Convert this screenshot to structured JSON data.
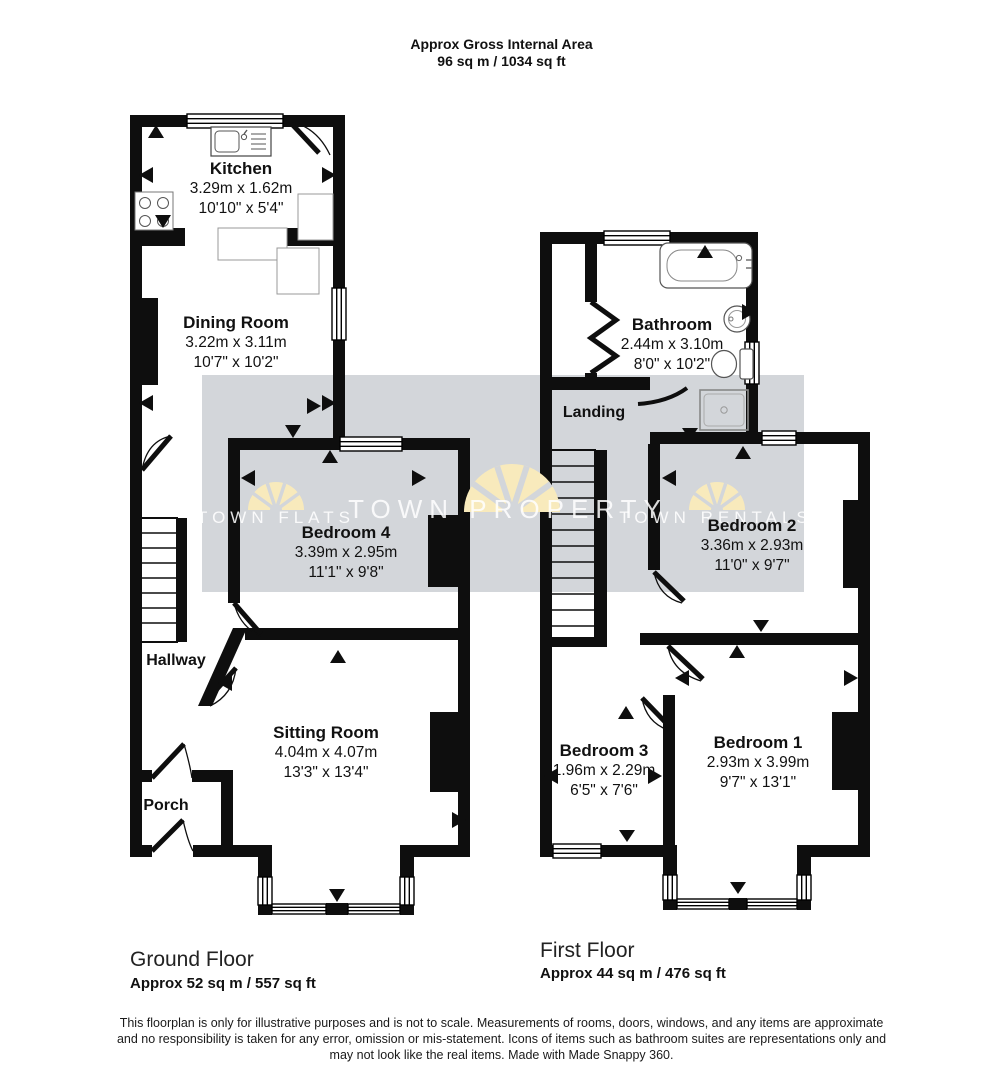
{
  "header": {
    "line1": "Approx Gross Internal Area",
    "line2": "96 sq m / 1034 sq ft"
  },
  "ground_floor": {
    "label": "Ground Floor",
    "area": "Approx 52 sq m / 557 sq ft",
    "rooms": {
      "kitchen": {
        "name": "Kitchen",
        "metric": "3.29m x 1.62m",
        "imperial": "10'10\" x 5'4\""
      },
      "dining_room": {
        "name": "Dining Room",
        "metric": "3.22m x 3.11m",
        "imperial": "10'7\" x 10'2\""
      },
      "bedroom4": {
        "name": "Bedroom 4",
        "metric": "3.39m x 2.95m",
        "imperial": "11'1\" x 9'8\""
      },
      "sitting_room": {
        "name": "Sitting Room",
        "metric": "4.04m x 4.07m",
        "imperial": "13'3\" x 13'4\""
      },
      "hallway": {
        "name": "Hallway"
      },
      "porch": {
        "name": "Porch"
      }
    }
  },
  "first_floor": {
    "label": "First Floor",
    "area": "Approx 44 sq m / 476 sq ft",
    "rooms": {
      "bathroom": {
        "name": "Bathroom",
        "metric": "2.44m x 3.10m",
        "imperial": "8'0\" x 10'2\""
      },
      "landing": {
        "name": "Landing"
      },
      "bedroom2": {
        "name": "Bedroom 2",
        "metric": "3.36m x 2.93m",
        "imperial": "11'0\" x 9'7\""
      },
      "bedroom3": {
        "name": "Bedroom 3",
        "metric": "1.96m x 2.29m",
        "imperial": "6'5\" x 7'6\""
      },
      "bedroom1": {
        "name": "Bedroom 1",
        "metric": "2.93m x 3.99m",
        "imperial": "9'7\" x 13'1\""
      }
    }
  },
  "watermarks": {
    "left": "TOWN FLATS",
    "center": "TOWN PROPERTY",
    "right": "TOWN RENTALS"
  },
  "disclaimer": {
    "lines": [
      "This floorplan is only for illustrative purposes and is not to scale. Measurements of rooms, doors, windows, and any items are approximate",
      "and no responsibility is taken for any error, omission or mis-statement. Icons of items such as bathroom suites are representations only and",
      "may not look like the real items. Made with Made Snappy 360."
    ]
  },
  "colors": {
    "wall": "#0e0e0e",
    "watermark_band": "#d3d6da",
    "fan": "#f8eabc",
    "watermark_text": "#ffffff"
  }
}
